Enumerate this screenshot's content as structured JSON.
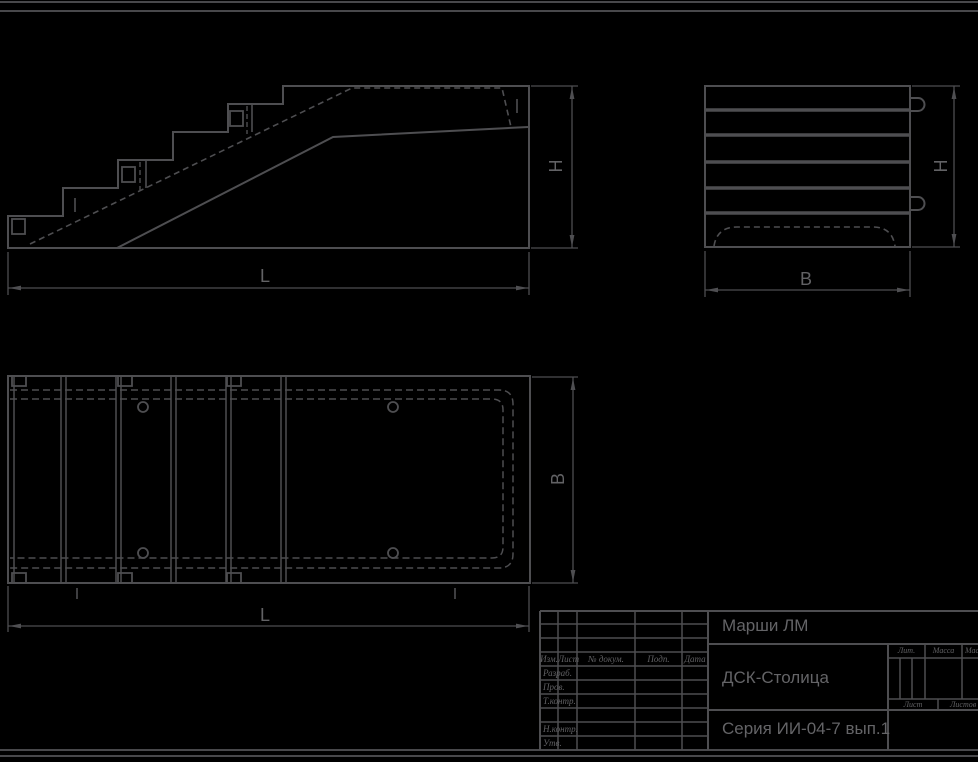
{
  "colors": {
    "background": "#000000",
    "line": "#4e4e51",
    "text": "#69696c"
  },
  "drawing": {
    "views": {
      "side": {
        "length_label": "L",
        "height_label": "H"
      },
      "end": {
        "width_label": "B",
        "height_label": "H"
      },
      "plan": {
        "length_label": "L",
        "width_label": "B"
      }
    }
  },
  "title_block": {
    "title": "Марши ЛМ",
    "organization": "ДСК-Столица",
    "series": "Серия ИИ-04-7 вып.1",
    "revision_header": {
      "izm": "Изм.",
      "list": "Лист",
      "doc": "№ докум.",
      "podp": "Подп.",
      "data": "Дата"
    },
    "signature_rows": {
      "developed": "Разраб.",
      "checked": "Пров.",
      "tcontrol": "Т.контр.",
      "ncontrol": "Н.контр.",
      "approved": "Утв."
    },
    "right": {
      "lit": "Лит.",
      "mass": "Масса",
      "scale": "Масштаб",
      "sheet": "Лист",
      "sheets": "Листов"
    }
  }
}
